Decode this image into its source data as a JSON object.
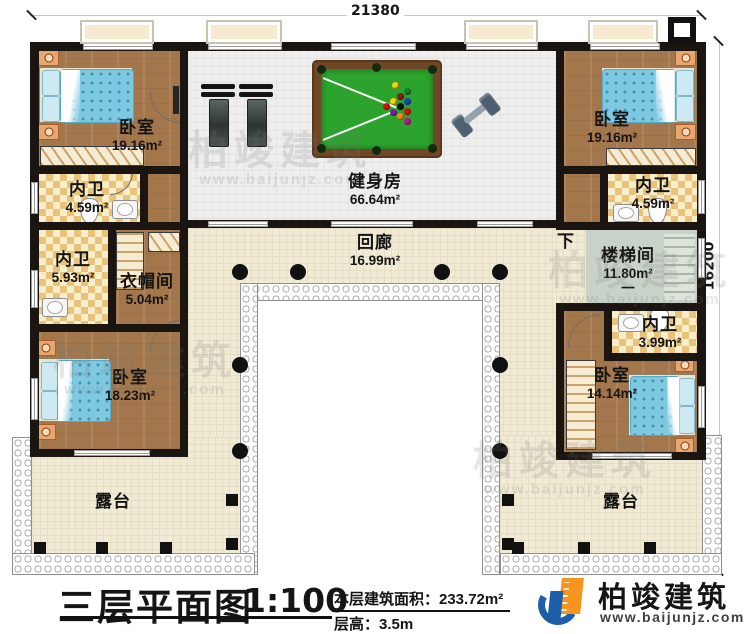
{
  "dimensions": {
    "width_label": "21380",
    "height_label": "16200"
  },
  "rooms": {
    "bedroom_tl": {
      "name": "卧室",
      "area": "19.16m²"
    },
    "bath_tl": {
      "name": "内卫",
      "area": "4.59m²"
    },
    "bath_ml": {
      "name": "内卫",
      "area": "5.93m²"
    },
    "cloakroom": {
      "name": "衣帽间",
      "area": "5.04m²"
    },
    "gym": {
      "name": "健身房",
      "area": "66.64m²"
    },
    "corridor": {
      "name": "回廊",
      "area": "16.99m²"
    },
    "bedroom_tr": {
      "name": "卧室",
      "area": "19.16m²"
    },
    "bath_tr": {
      "name": "内卫",
      "area": "4.59m²"
    },
    "stairwell": {
      "name": "楼梯间",
      "area": "11.80m²",
      "mark": "一"
    },
    "bath_br": {
      "name": "内卫",
      "area": "3.99m²"
    },
    "bedroom_br": {
      "name": "卧室",
      "area": "14.14m²"
    },
    "bedroom_bl": {
      "name": "卧室",
      "area": "18.23m²"
    },
    "terrace_left": {
      "name": "露台"
    },
    "terrace_right": {
      "name": "露台"
    }
  },
  "annotations": {
    "stairs_down": "下"
  },
  "title_block": {
    "title": "三层平面图",
    "scale": "1:100",
    "floor_area": "本层建筑面积：233.72m²",
    "floor_height": "层高：3.5m"
  },
  "brand": {
    "name": "柏竣建筑",
    "website": "www.baijunjz.com"
  },
  "watermark": {
    "text": "柏竣建筑",
    "website": "www.baijunjz.com"
  },
  "colors": {
    "wall": "#1a1511",
    "wood_floor": "#a3774b",
    "bath_tile": "#e9c37c",
    "corridor_floor": "#f1ebd6",
    "gym_floor": "#eeeeee",
    "stair_floor": "#c9d2c8",
    "billiard_felt": "#2ca32c",
    "bed_duvet": "#7fc9e0",
    "brand_blue": "#1c5fa8",
    "brand_orange": "#f7941d"
  }
}
